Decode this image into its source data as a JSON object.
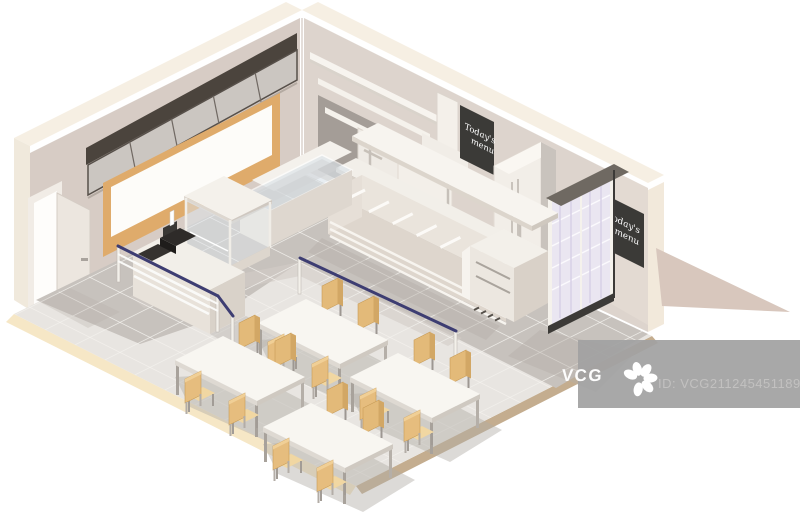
{
  "chalkboards": [
    {
      "line1": "Today's",
      "line2": "menu"
    },
    {
      "line1": "Today's",
      "line2": "menu"
    }
  ],
  "watermark": {
    "logo_text": "VCG",
    "id_text": "ID: VCG211245451189",
    "logo_icon": "vcg-starburst"
  },
  "colors": {
    "background": "#ffffff",
    "wall_left": "#d7ccc5",
    "wall_right": "#ddd4cd",
    "wall_top": "#f6efe3",
    "window_frame": "#dfab6b",
    "menu_board_dark": "#4b443d",
    "menu_screen": "#cbc6c1",
    "chalkboard": "#3b3a37",
    "chalk_text": "#ffffff",
    "floor": "#e8e5e1",
    "kitchen_floor": "#c7c2bd",
    "floor_edge_cream": "#f6e7c6",
    "floor_edge_tan": "#c4ad8f",
    "tray_rail_navy": "#3d3d72",
    "counter_white": "#f2efe9",
    "chair_tan": "#e4bb7c",
    "table_white": "#f8f6f1",
    "cooler_glass": "#eae6f1",
    "shadow": "#b5afa9",
    "outside_shadow": "#d8c7bd",
    "watermark_bar": "#a1a1a1",
    "watermark_id_text": "#c2c1c0"
  }
}
